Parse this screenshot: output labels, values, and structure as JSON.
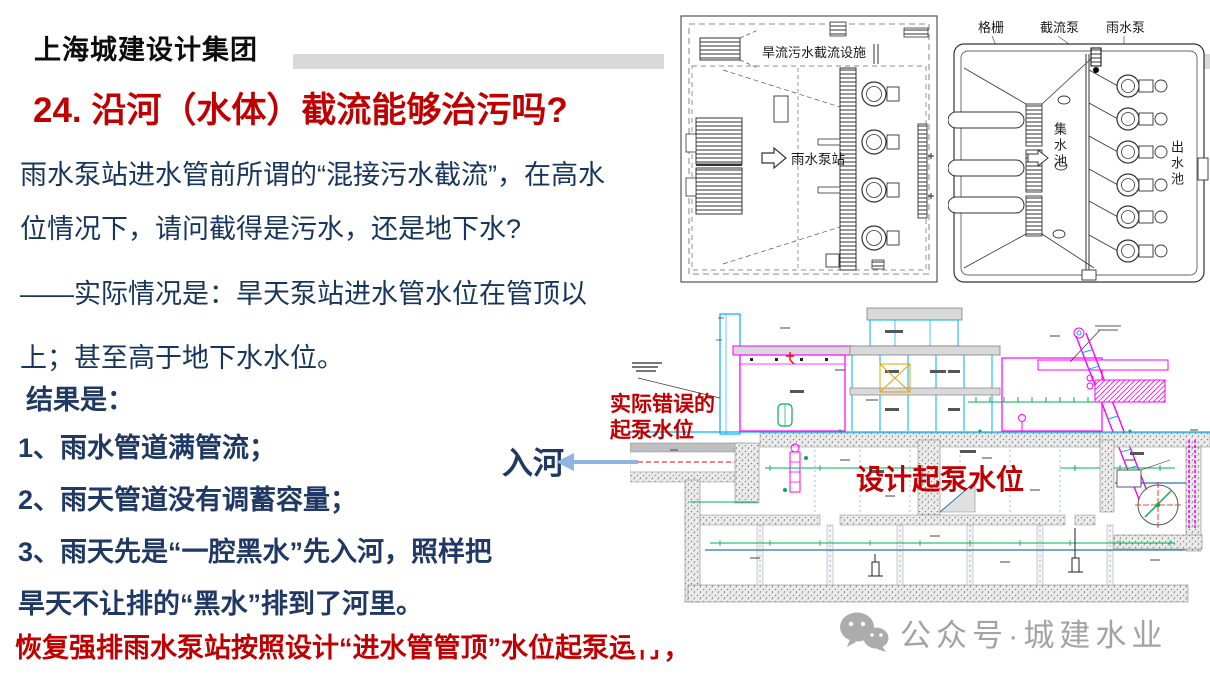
{
  "slide": {
    "logo": "上海城建设计集团",
    "title": "24. 沿河（水体）截流能够治污吗?",
    "paragraph1": {
      "lines": [
        "雨水泵站进水管前所谓的“混接污水截流”，在高水",
        "位情况下，请问截得是污水，还是地下水?"
      ]
    },
    "paragraph2": {
      "lines": [
        "——实际情况是：旱天泵站进水管水位在管顶以",
        "上；甚至高于地下水水位。"
      ]
    },
    "results": {
      "heading": "结果是：",
      "items": [
        "1、雨水管道满管流；",
        "2、雨天管道没有调蓄容量；",
        "3、雨天先是“一腔黑水”先入河，照样把",
        "旱天不让排的“黑水”排到了河里。"
      ]
    },
    "conclusion": "恢复强排雨水泵站按照设计“进水管管顶”水位起泵运行；"
  },
  "plan_diagram": {
    "facility_label": "旱流污水截流设施",
    "station_label": "雨水泵站"
  },
  "station_diagram": {
    "grille_label": "格栅",
    "intercept_pump_label": "截流泵",
    "rain_pump_label": "雨水泵",
    "sump_label": "集水池",
    "outlet_label": "出水池"
  },
  "section_diagram": {
    "wrong_level_line1": "实际错误的",
    "wrong_level_line2": "起泵水位",
    "design_level_label": "设计起泵水位",
    "to_river_label": "入河"
  },
  "watermark": {
    "text": "公众号·城建水业",
    "icon": "wechat-icon"
  },
  "colors": {
    "title_red": "#C00000",
    "body_navy": "#17365D",
    "list_navy": "#1F3864",
    "arrow_blue": "#8DB4E2",
    "bar_gray": "#D9D9D9",
    "cad_magenta": "#FF00FF",
    "cad_cyan": "#00B0F0",
    "cad_green": "#00B050",
    "water_blue": "#2E74B5",
    "watermark_gray": "#8F8F8F"
  }
}
